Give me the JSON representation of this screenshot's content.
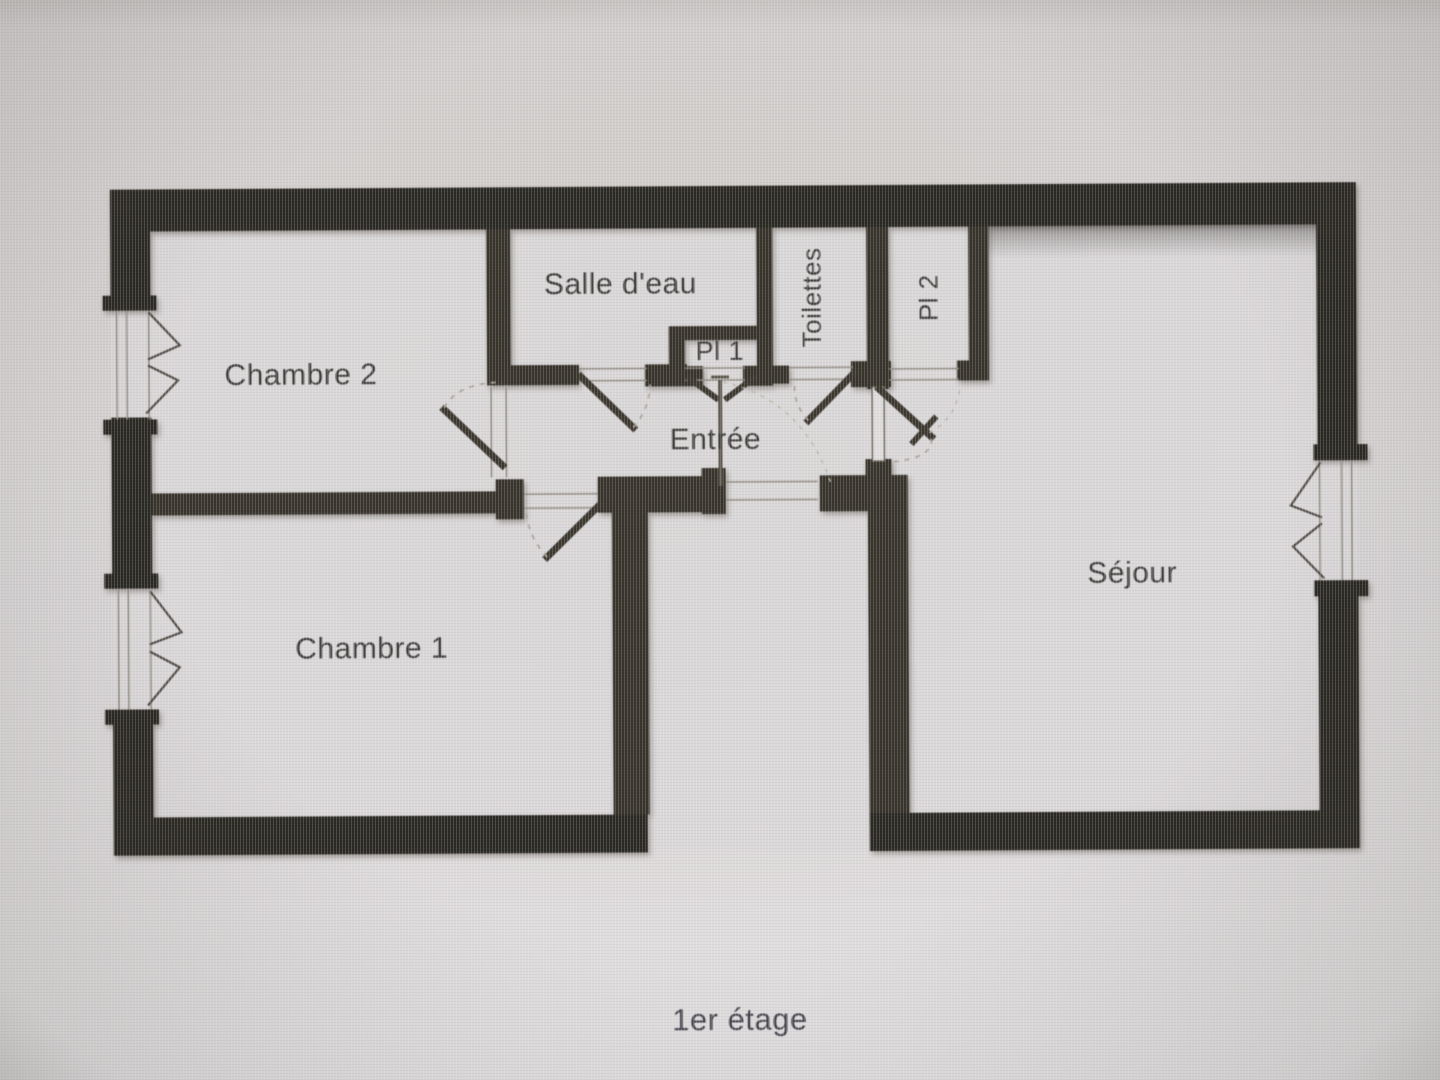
{
  "plan": {
    "caption": "1er étage",
    "rooms": {
      "chambre2": {
        "label": "Chambre 2"
      },
      "salle_deau": {
        "label": "Salle d'eau"
      },
      "pl1": {
        "label": "Pl 1"
      },
      "toilettes": {
        "label": "Toilettes"
      },
      "pl2": {
        "label": "Pl 2"
      },
      "entree": {
        "label": "Entrée"
      },
      "sejour": {
        "label": "Séjour"
      },
      "chambre1": {
        "label": "Chambre 1"
      }
    },
    "colors": {
      "wall": "#2a2822",
      "interior_wall": "#37332b",
      "door_leaf": "#3b372f",
      "swing_arc": "#a9a399",
      "label_text": "#3c3b39",
      "background": "#d5d2d1"
    }
  }
}
